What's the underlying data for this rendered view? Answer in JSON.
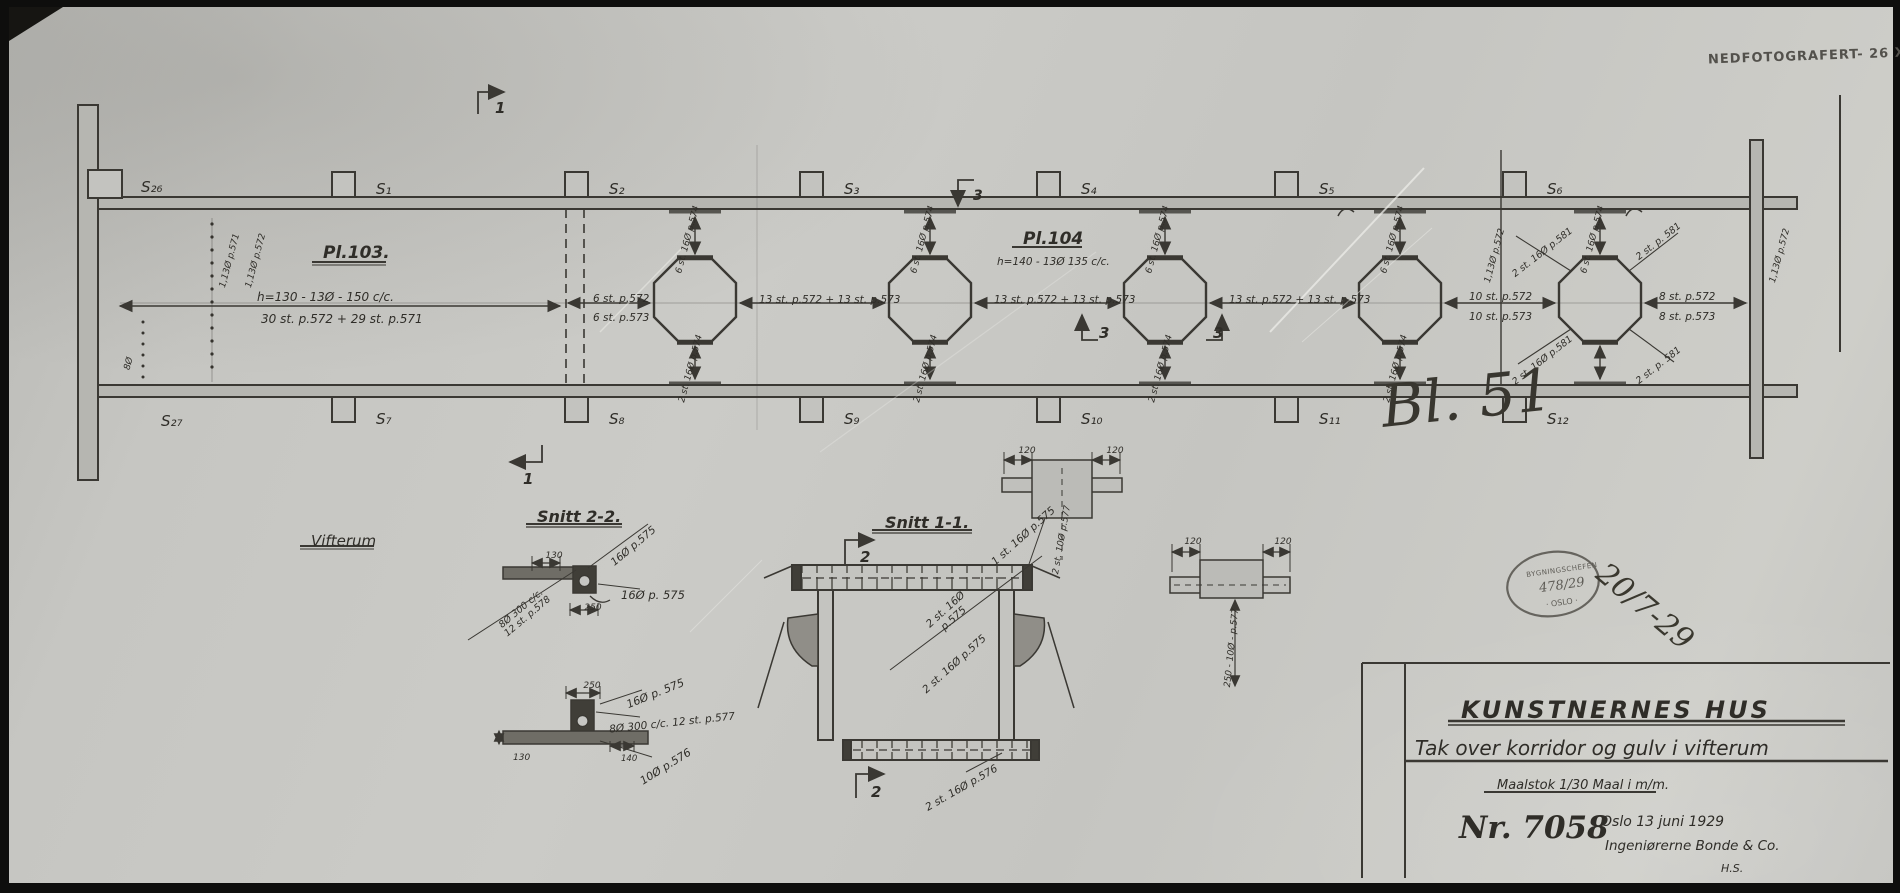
{
  "photo_note": "NEDFOTOGRAFERT- 26 X",
  "handwritten": {
    "sheet": "Bl. 51",
    "date": "20/7-29"
  },
  "approval_stamp": {
    "org": "BYGNINGSCHEFEN",
    "number": "478/29",
    "city": "· OSLO ·"
  },
  "plan": {
    "pl103": "Pl.103.",
    "pl103_note1": "h=130 - 13Ø - 150 c/c.",
    "pl103_note2": "30 st. p.572 + 29 st. p.571",
    "pl104": "Pl.104",
    "pl104_note": "h=140 - 13Ø 135 c/c.",
    "beams_top": [
      "S₁",
      "S₂",
      "S₃",
      "S₄",
      "S₅",
      "S₆"
    ],
    "beams_bottom": [
      "S₇",
      "S₈",
      "S₉",
      "S₁₀",
      "S₁₁",
      "S₁₂"
    ],
    "beam_top_left": "S₂₆",
    "beam_bottom_left": "S₂₇",
    "left_bars_1": "1,13Ø p.571",
    "left_bars_2": "1,13Ø p.572",
    "left_stirrup": "8Ø",
    "right_bars": "1,13Ø p.572",
    "dim_a_top": "6 st. p.572",
    "dim_a_bot": "6 st. p.573",
    "dim_mid": "13 st. p.572 + 13 st. p.573",
    "dim_b_top": "10 st. p.572",
    "dim_b_bot": "10 st. p.573",
    "dim_c_top": "8 st. p.572",
    "dim_c_bot": "8 st. p.573",
    "opening_top": "6 st. 16Ø p.574",
    "opening_bottom": "2 st. 16Ø p.574",
    "corner_l": "2 st. 16Ø p.581",
    "corner_r": "2 st. p. 581",
    "sec1": "1",
    "sec2": "2",
    "sec3": "3"
  },
  "sections": {
    "room": "Vifterum",
    "snitt22": {
      "title": "Snitt 2-2.",
      "diag": "16Ø p.575",
      "dim_w": "130",
      "stirr1": "8Ø 300 c/c.",
      "stirr2": "12 st. p.578",
      "bar": "16Ø p. 575",
      "dim_b": "250"
    },
    "floor": {
      "dim_w": "250",
      "bar_top": "16Ø p. 575",
      "stirr": "8Ø 300 c/c. 12 st. p.577",
      "dim_slab": "130",
      "dim_web": "140",
      "bar_bot": "10Ø p.576"
    },
    "snitt11": {
      "title": "Snitt 1-1.",
      "bar1": "1 st. 16Ø p.575",
      "bar2a": "2 st. 16Ø",
      "bar2b": "p.575",
      "bar3": "2 st. 16Ø p.575",
      "bar4": "2 st. 16Ø p.576"
    },
    "detail_a": {
      "dim1": "120",
      "dim2": "120",
      "bars": "2 st. 10Ø p.577"
    },
    "detail_b": {
      "dim1": "120",
      "dim2": "120",
      "bars": "250 - 10Ø - p.577"
    }
  },
  "titleblock": {
    "project": "KUNSTNERNES HUS",
    "subject": "Tak over korridor og gulv i vifterum",
    "scale": "Maalstok 1/30   Maal i m/m.",
    "number": "Nr. 7058",
    "place_date": "Oslo 13 juni 1929",
    "firm": "Ingeniørerne Bonde & Co.",
    "initials": "H.S."
  }
}
